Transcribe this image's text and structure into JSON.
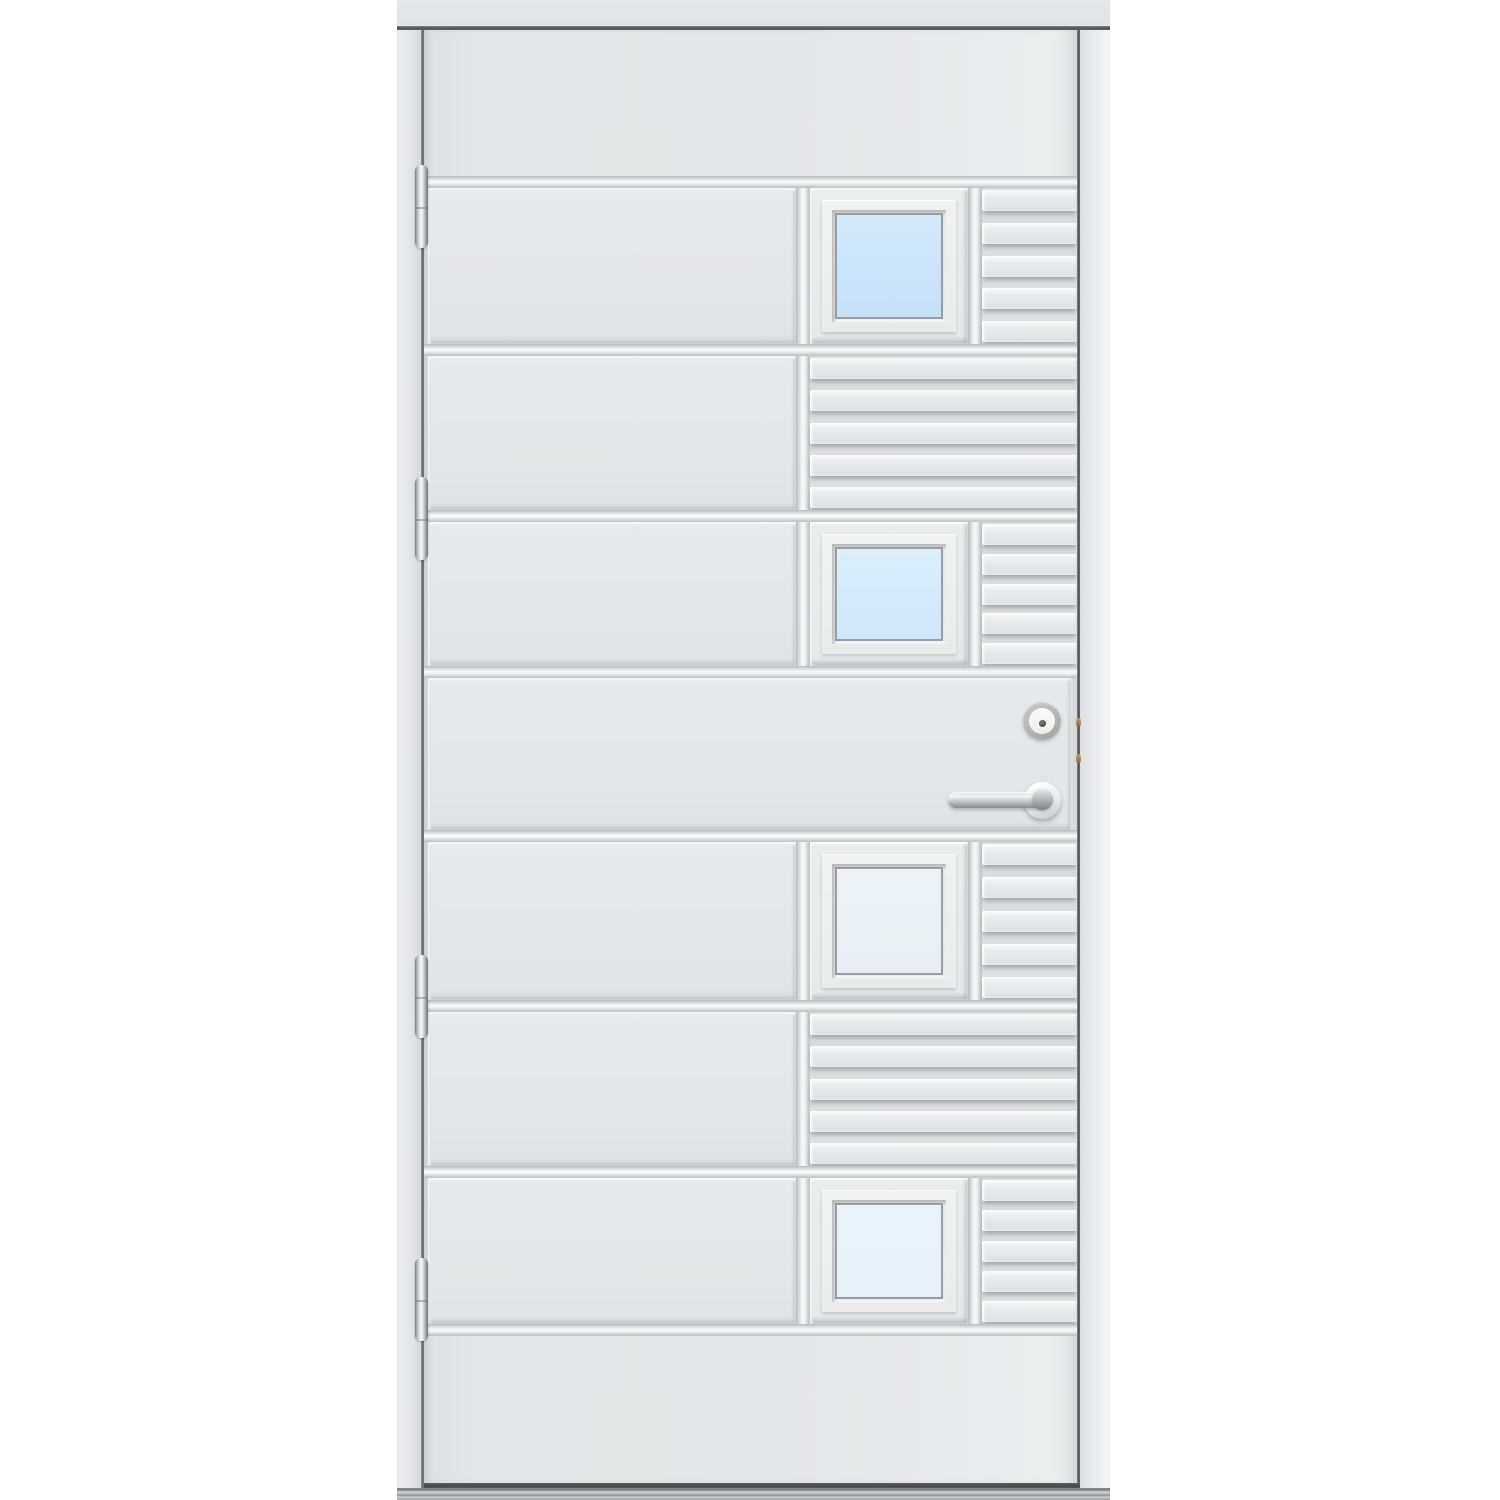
{
  "scene": {
    "type": "product-photo",
    "subject": "White exterior entry door with four small square windows, horizontal slat relief pattern, steel lever handle, lock cylinder, four hinges and aluminium threshold",
    "background_color": "#ffffff"
  },
  "palette": {
    "door_surface": "#e5e6e7",
    "panel_face": "#e6e7e8",
    "groove_highlight": "#f7f8f8",
    "groove_shadow": "#b9babb",
    "frame_gap_line": "#5a5d60",
    "door_edge_line": "#54575b",
    "head_gap_line": "#505254",
    "steel_light": "#f2f3f4",
    "steel_dark": "#7e8083",
    "threshold_dark": "#7a7b7e",
    "threshold_light": "#d2d3d4"
  },
  "structure": {
    "rows": [
      "plain",
      "window",
      "slats",
      "window",
      "lock",
      "window",
      "slats",
      "window",
      "plain"
    ],
    "slats_per_section": 5,
    "horizontal_grooves": 8,
    "vertical_groove_columns": 2
  },
  "windows": [
    {
      "name": "window-1",
      "glass": "linear-gradient(180deg, #d3e9fb 0%, #c6e0f6 100%)"
    },
    {
      "name": "window-2",
      "glass": "linear-gradient(180deg, #dceefb 0%, #cfe7f9 100%)"
    },
    {
      "name": "window-3",
      "glass": "linear-gradient(180deg, #edf2f6 0%, #e7eef3 100%)"
    },
    {
      "name": "window-4",
      "glass": "linear-gradient(180deg, #eaf2fa 0%, #e8f0f7 100%)"
    }
  ],
  "hardware": {
    "hinges": {
      "count": 4,
      "finish_light": "#f6f7f8",
      "finish_dark": "#737477"
    },
    "handle": {
      "style": "straight-lever-on-round-rosette",
      "finish_light": "#f2f3f3",
      "finish_dark": "#8a8b8e"
    },
    "lock_cylinder": {
      "ring": "#b3b4b2",
      "face": "#f5f5f4",
      "keyhole": "#4e4236"
    }
  },
  "threshold": {
    "finish_dark": "#77787b",
    "finish_light": "#d4d5d6"
  }
}
